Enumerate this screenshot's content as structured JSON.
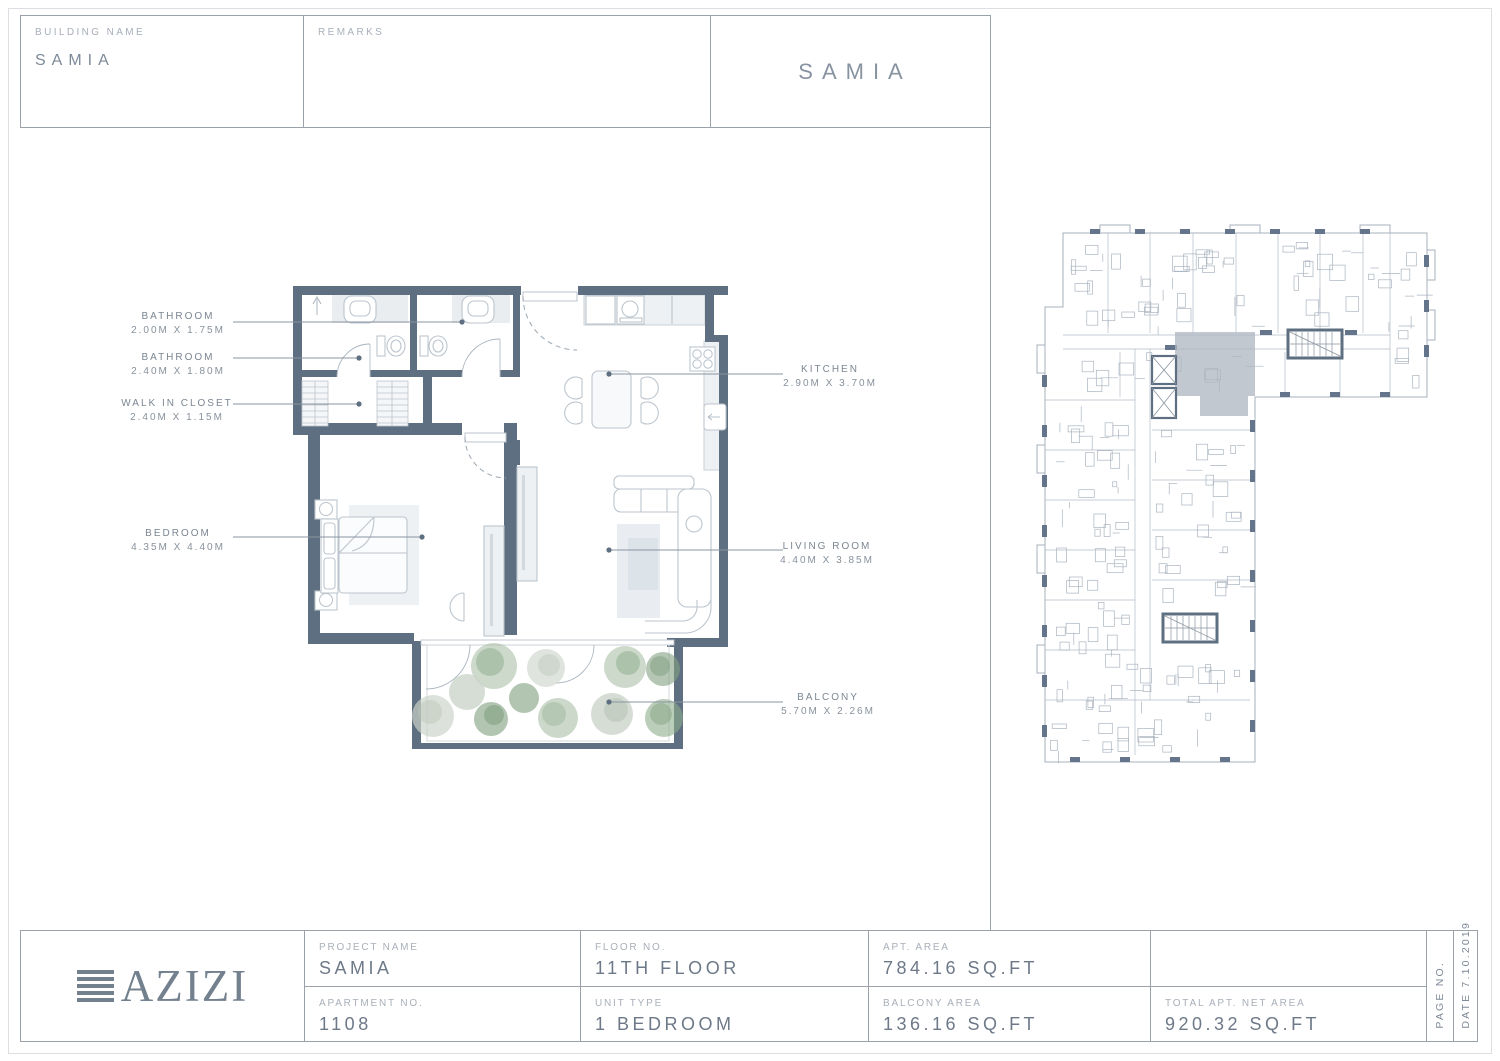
{
  "header": {
    "building_name_label": "BUILDING NAME",
    "building_name": "SAMIA",
    "remarks_label": "REMARKS",
    "sheet_title": "SAMIA"
  },
  "rooms": [
    {
      "name": "BATHROOM",
      "dims": "2.00M X 1.75M"
    },
    {
      "name": "BATHROOM",
      "dims": "2.40M X 1.80M"
    },
    {
      "name": "WALK IN CLOSET",
      "dims": "2.40M X 1.15M"
    },
    {
      "name": "BEDROOM",
      "dims": "4.35M X 4.40M"
    },
    {
      "name": "KITCHEN",
      "dims": "2.90M X 3.70M"
    },
    {
      "name": "LIVING ROOM",
      "dims": "4.40M X 3.85M"
    },
    {
      "name": "BALCONY",
      "dims": "5.70M X 2.26M"
    }
  ],
  "title_block": {
    "logo_text": "AZIZI",
    "fields": [
      {
        "label": "PROJECT NAME",
        "value": "SAMIA"
      },
      {
        "label": "FLOOR NO.",
        "value": "11TH FLOOR"
      },
      {
        "label": "APT. AREA",
        "value": "784.16 SQ.FT"
      },
      {
        "label": "APARTMENT NO.",
        "value": "1108"
      },
      {
        "label": "UNIT TYPE",
        "value": "1 BEDROOM"
      },
      {
        "label": "BALCONY AREA",
        "value": "136.16 SQ.FT"
      },
      {
        "label": "TOTAL APT. NET AREA",
        "value": "920.32 SQ.FT"
      }
    ],
    "page_no_label": "PAGE NO.",
    "date_label": "DATE 7.10.2019"
  },
  "colors": {
    "wall": "#5d6f80",
    "key_plan_highlight": "#aeb6c0",
    "plant_green": "#8fae8d",
    "grid_line": "#9aa1a9"
  }
}
